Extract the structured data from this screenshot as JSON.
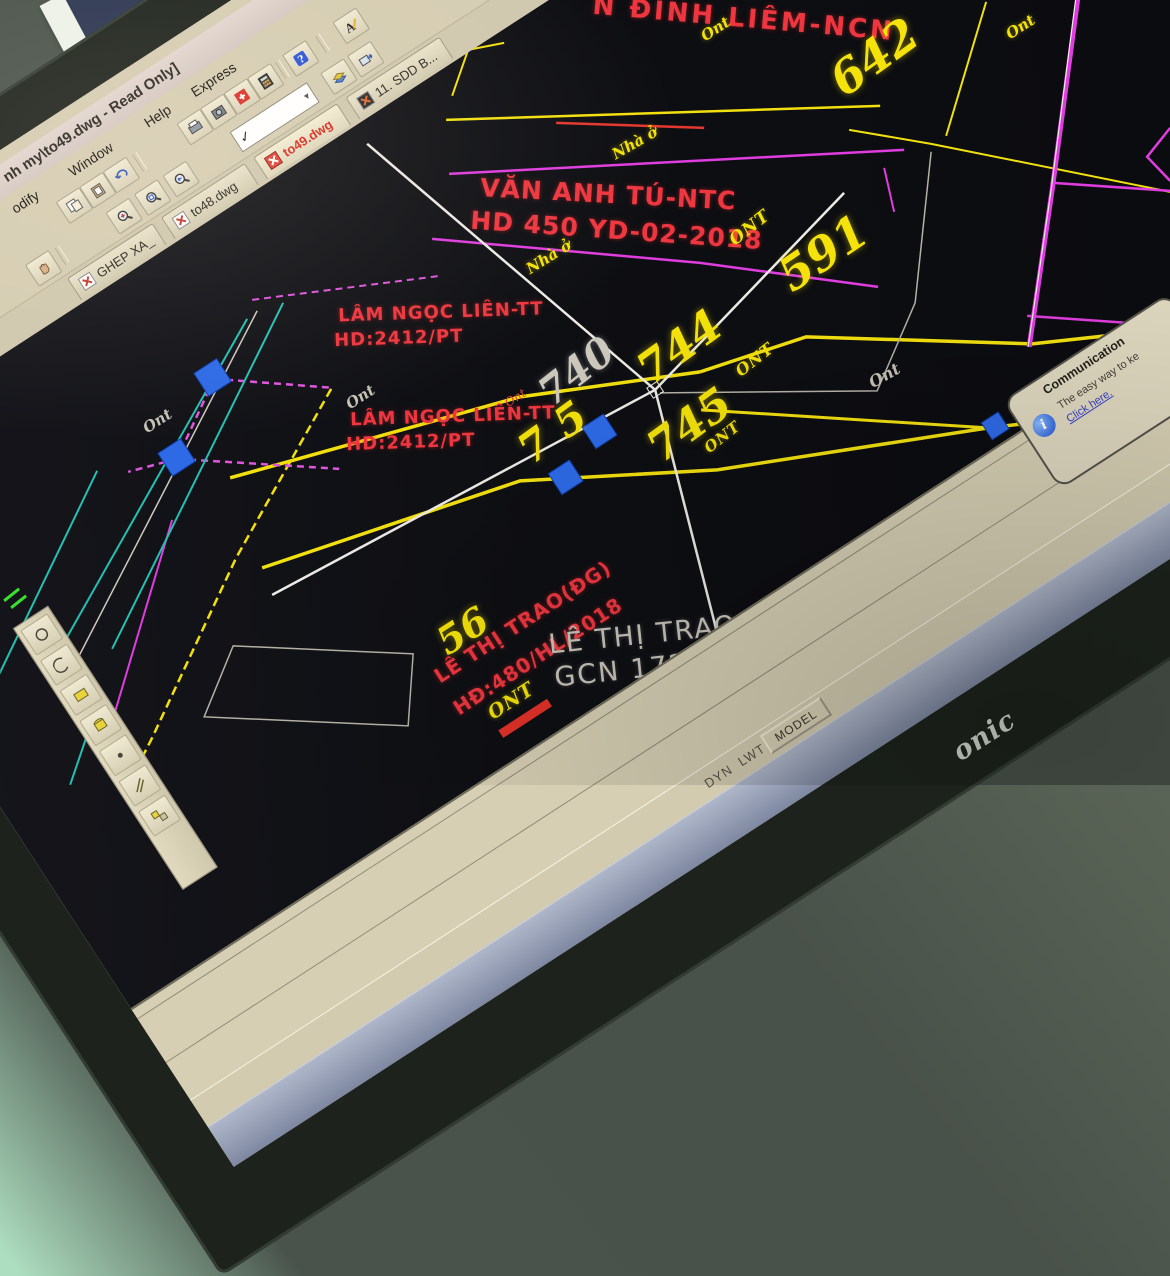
{
  "window": {
    "title_tail": "nh my\\to49.dwg - Read Only]"
  },
  "menu": {
    "items": [
      "odify",
      "Window",
      "Help",
      "Express"
    ]
  },
  "layer_combo": {
    "value": "✓"
  },
  "doc_tabs": {
    "items": [
      {
        "label": "GHEP XA_"
      },
      {
        "label": "to48.dwg"
      },
      {
        "label": "to49.dwg"
      },
      {
        "label": "11. SDD B..."
      }
    ],
    "active": "to49.dwg"
  },
  "statusbar": {
    "toggles": [
      "DYN",
      "LWT"
    ],
    "model_button": "MODEL"
  },
  "balloon": {
    "title": "Communication",
    "body": "The easy way to ke",
    "link": "Click here."
  },
  "monitor": {
    "brand_partial": "onic"
  },
  "map": {
    "labels": [
      {
        "id": "owner-top",
        "text": "N ĐÌNH LIÊM-NCN"
      },
      {
        "id": "ont-a",
        "text": "Ont"
      },
      {
        "id": "parcel-642",
        "text": "642"
      },
      {
        "id": "ont-b",
        "text": "Ont"
      },
      {
        "id": "nha-o-1",
        "text": "Nhà ở"
      },
      {
        "id": "owner-van-anh-tu",
        "text": "VĂN ANH TÚ-NTC"
      },
      {
        "id": "contract-hd450",
        "text": "HD 450 YD-02-2018"
      },
      {
        "id": "nha-o-2",
        "text": "Nhà ở"
      },
      {
        "id": "ont-c",
        "text": "ONT"
      },
      {
        "id": "parcel-591",
        "text": "591"
      },
      {
        "id": "owner-lam-1",
        "text": "LÂM NGỌC LIÊN-TT"
      },
      {
        "id": "contract-lam-1",
        "text": "HD:2412/PT"
      },
      {
        "id": "ont-gray-1",
        "text": "Ont"
      },
      {
        "id": "owner-lam-2",
        "text": "LÂM NGỌC LIÊN-TT"
      },
      {
        "id": "contract-lam-2",
        "text": "HD:2412/PT"
      },
      {
        "id": "parcel-740",
        "text": "740"
      },
      {
        "id": "parcel-744",
        "text": "744"
      },
      {
        "id": "parcel-745",
        "text": "745"
      },
      {
        "id": "parcel-7-5",
        "text": "7 5"
      },
      {
        "id": "ont-d",
        "text": "ONT"
      },
      {
        "id": "ont-gray-2",
        "text": "Ont"
      },
      {
        "id": "ont-e",
        "text": "ONT"
      },
      {
        "id": "ont-gray-3",
        "text": "Ont"
      },
      {
        "id": "ont-red",
        "text": "Ont"
      },
      {
        "id": "parcel-56",
        "text": "56"
      },
      {
        "id": "owner-trao-1",
        "text": "LÊ THỊ TRAO(ĐG)"
      },
      {
        "id": "contract-trao",
        "text": "HĐ:480/HL/2018"
      },
      {
        "id": "ont-f",
        "text": "ONT"
      },
      {
        "id": "owner-trao-gray",
        "text": "LÊ THỊ TRAO-N"
      },
      {
        "id": "gcn-gray",
        "text": "GCN 172 N"
      }
    ]
  },
  "colors": {
    "canvas": "#0e0f13",
    "parcel_yellow": "#f2e00e",
    "boundary_magenta": "#df3ddf",
    "boundary_cyan": "#25c0b2",
    "owner_red": "#ee3640",
    "selected_gray": "#c9c4ba",
    "grip_blue": "#2e6ae6",
    "chrome_beige": "#d5cdb2"
  }
}
